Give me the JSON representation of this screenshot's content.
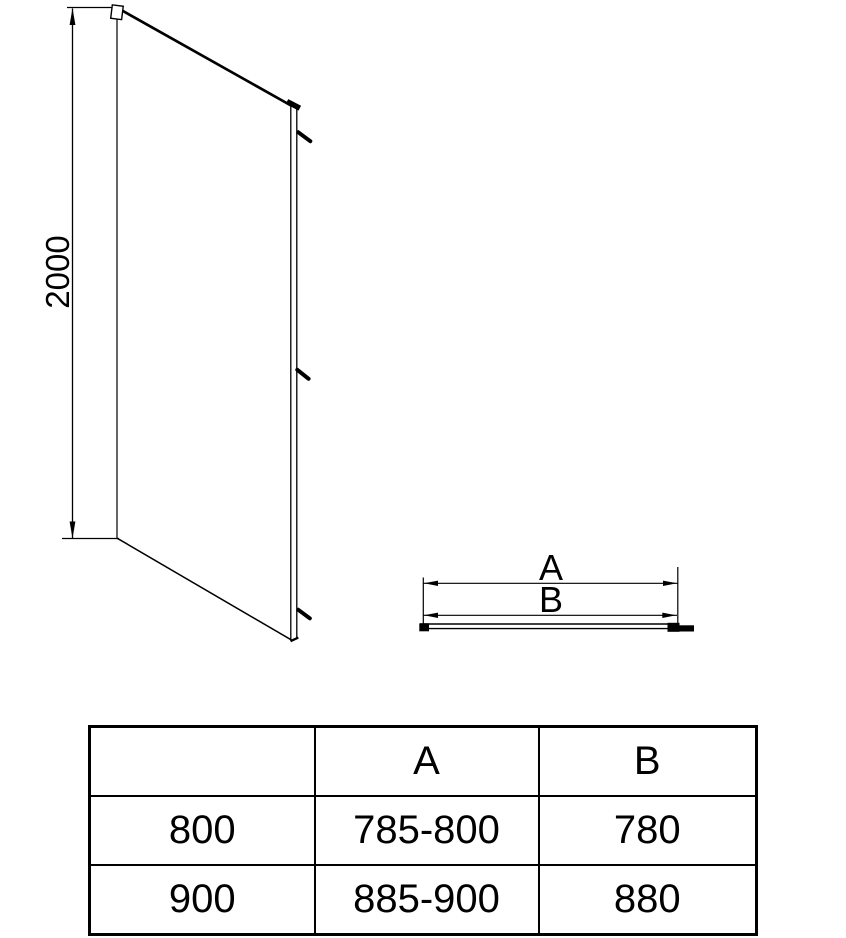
{
  "colors": {
    "line": "#000000",
    "background": "#ffffff"
  },
  "elevation": {
    "height_dim_label": "2000"
  },
  "plan": {
    "dim_a_label": "A",
    "dim_b_label": "B"
  },
  "table": {
    "col_headers": [
      "",
      "A",
      "B"
    ],
    "rows": [
      {
        "width": "800",
        "a": "785-800",
        "b": "780"
      },
      {
        "width": "900",
        "a": "885-900",
        "b": "880"
      }
    ]
  }
}
